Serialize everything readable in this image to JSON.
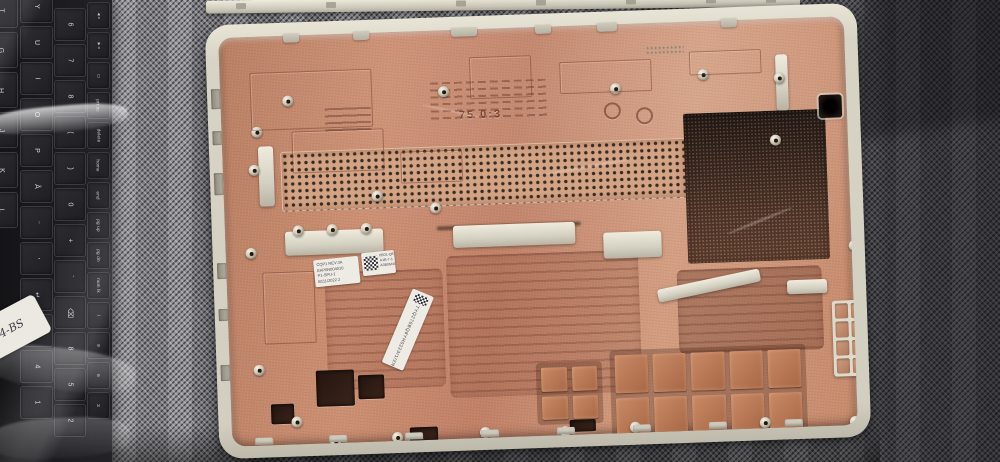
{
  "scene": {
    "description": "Photograph: interior of a silver laptop bottom-case shell coated with copper EMI shielding, lying on grey woven fabric; a plastic-wrapped black laptop keyboard lies along the left edge with a handwritten label.",
    "objects": [
      "laptop-bottom-case",
      "laptop-keyboard-in-plastic",
      "woven-fabric-background",
      "metal-edge-strip"
    ]
  },
  "keyboard": {
    "label_text": "14-BS",
    "columns": [
      {
        "keys": [
          "T",
          "G",
          "H",
          "J",
          "K",
          "L"
        ]
      },
      {
        "keys": [
          "Y",
          "U",
          "I",
          "O",
          "P",
          "Å",
          "¨",
          "'",
          "↵",
          "7",
          "4",
          "1"
        ]
      },
      {
        "keys": [
          "6",
          "7",
          "8",
          "(",
          ")",
          "0",
          "+",
          "´",
          "⌫",
          "8",
          "5",
          "2"
        ]
      },
      {
        "keys": [
          "◄»",
          "►»",
          "▭",
          "prt sc",
          "delete",
          "home",
          "end",
          "pg up",
          "pg dn",
          "num lk",
          "/",
          "9",
          "6",
          "3"
        ]
      }
    ]
  },
  "case": {
    "stickers": {
      "part_label_lines": [
        "CQP1 REV:3A",
        "EAP0N004010",
        "P1-SPU-1",
        "B111/2022 2"
      ],
      "qr_label_lines": [
        "0B01-Q87-3",
        "A1B-7-1",
        "A3B0M4Q1"
      ],
      "barcode_label_text": "TYQ270BQ8YH0223/1/2N"
    },
    "molded_marks": {
      "mold_id": "75 0:3"
    }
  },
  "colors": {
    "fabric_light": "#96959a",
    "fabric_dark": "#3d3c40",
    "case_rim": "#dcd8cb",
    "copper_base": "#c88a6c",
    "copper_light": "#d7a184",
    "vent_hole": "#3a2a20",
    "mesh_dark": "#332620",
    "sticker": "#edebe3",
    "key_cap": "#26262a"
  }
}
